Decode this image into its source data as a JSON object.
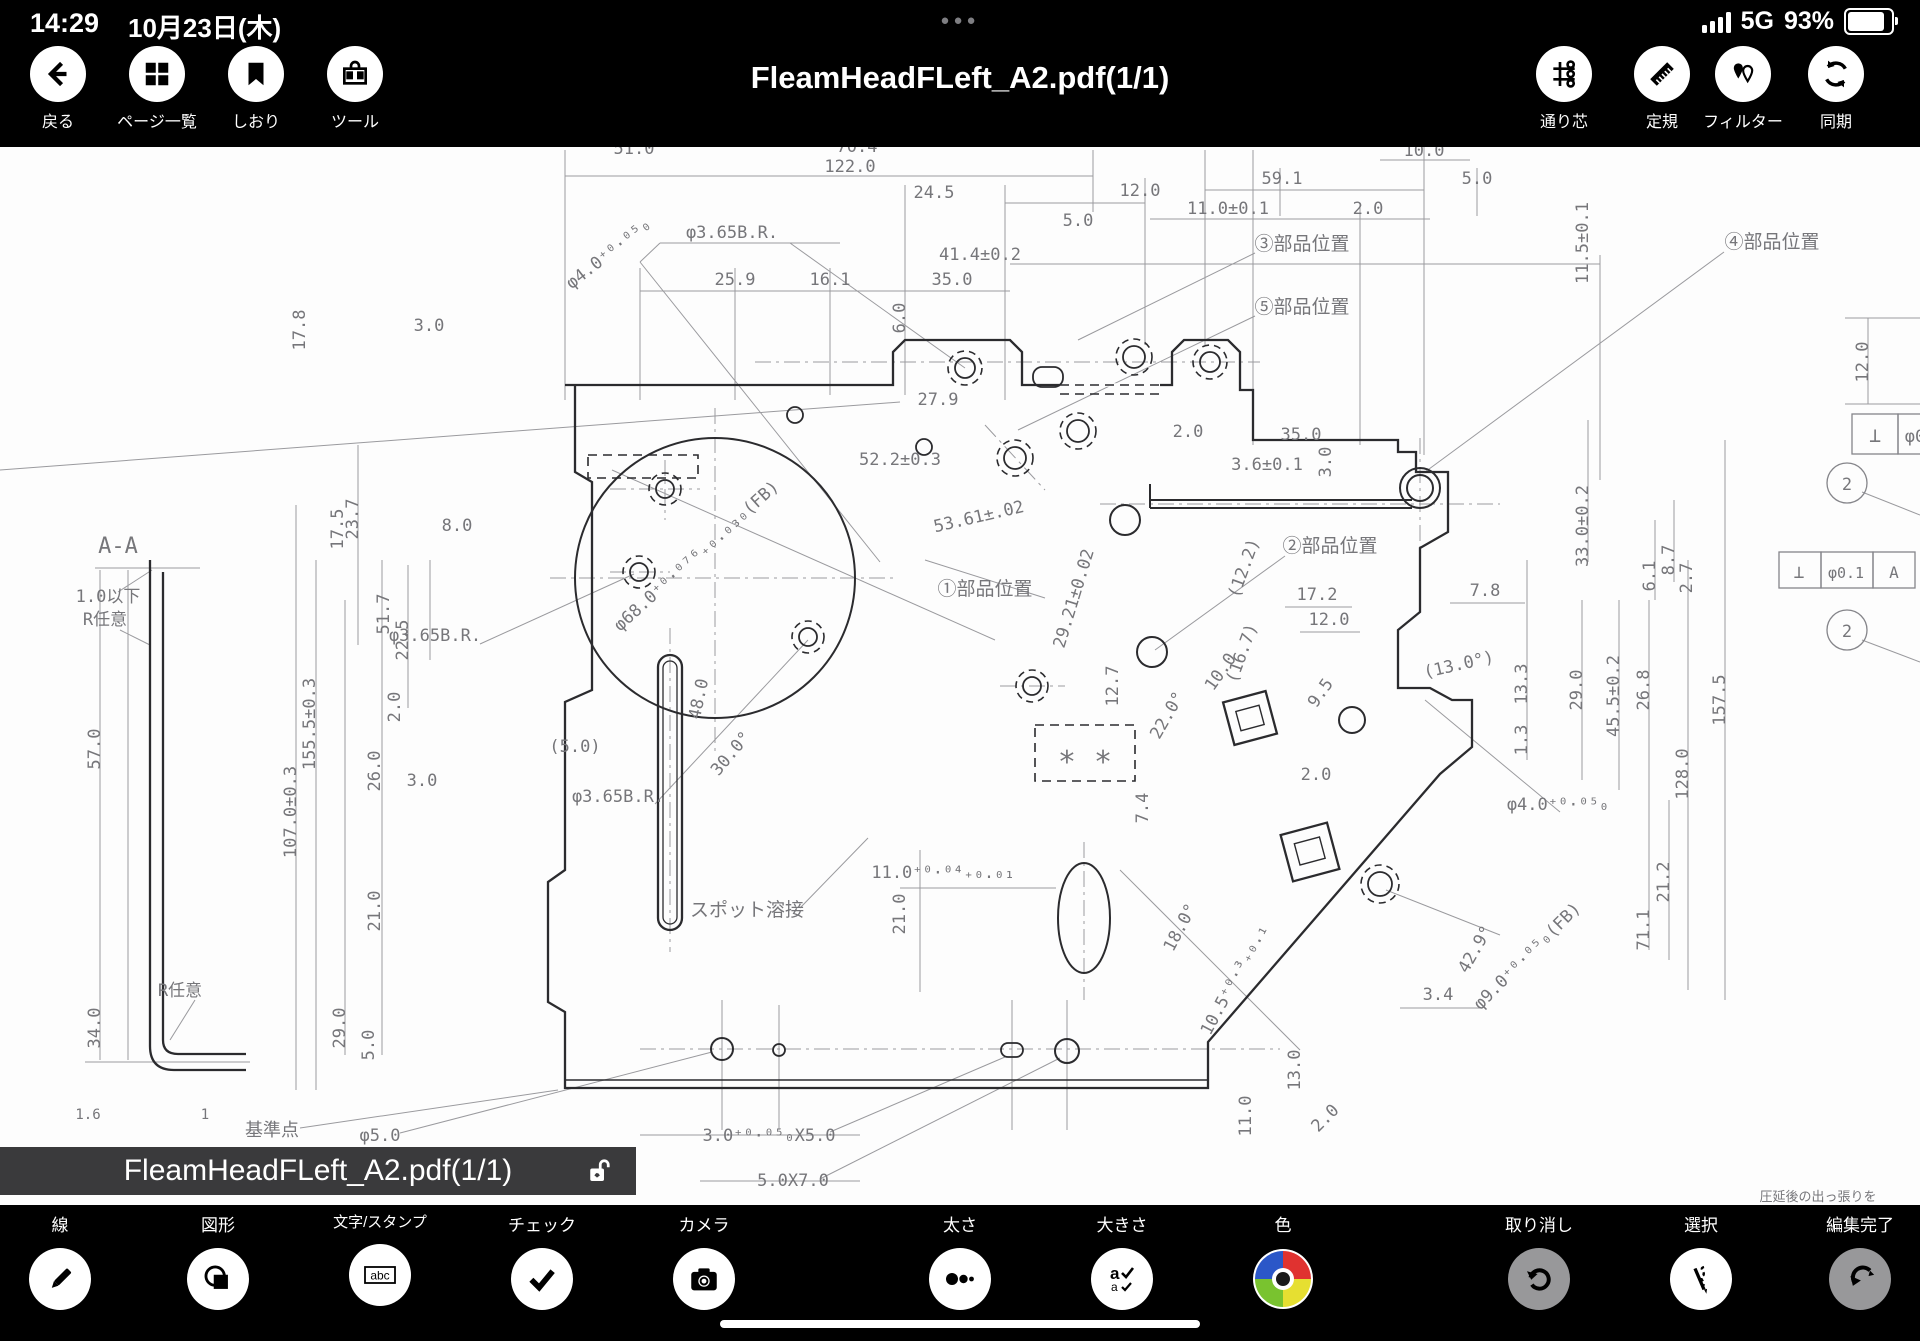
{
  "status_bar": {
    "time": "14:29",
    "date": "10月23日(木)",
    "network": "5G",
    "battery_percent": "93%"
  },
  "nav_bar": {
    "title": "FleamHeadFLeft_A2.pdf(1/1)",
    "left_items": [
      {
        "label": "戻る"
      },
      {
        "label": "ページ一覧"
      },
      {
        "label": "しおり"
      },
      {
        "label": "ツール"
      }
    ],
    "right_items": [
      {
        "label": "通り芯"
      },
      {
        "label": "定規"
      },
      {
        "label": "フィルター"
      },
      {
        "label": "同期"
      }
    ]
  },
  "file_bar": {
    "filename": "FleamHeadFLeft_A2.pdf(1/1)"
  },
  "toolbar": {
    "items": [
      {
        "label": "線"
      },
      {
        "label": "図形"
      },
      {
        "label": "文字/スタンプ"
      },
      {
        "label": "チェック"
      },
      {
        "label": "カメラ"
      },
      {
        "label": "太さ"
      },
      {
        "label": "大きさ"
      },
      {
        "label": "色"
      },
      {
        "label": "取り消し"
      },
      {
        "label": "選択"
      },
      {
        "label": "編集完了"
      }
    ],
    "color_wheel": {
      "blue": "#2b57c8",
      "red": "#e03230",
      "green": "#79c32f",
      "yellow": "#e6df31"
    }
  },
  "drawing": {
    "section_label": "A-A",
    "labels": [
      {
        "t": "51.0",
        "x": 634,
        "y": 154
      },
      {
        "t": "70.4",
        "x": 857,
        "y": 152
      },
      {
        "t": "122.0",
        "x": 850,
        "y": 172
      },
      {
        "t": "24.5",
        "x": 934,
        "y": 198
      },
      {
        "t": "12.0",
        "x": 1140,
        "y": 196
      },
      {
        "t": "5.0",
        "x": 1078,
        "y": 226
      },
      {
        "t": "59.1",
        "x": 1282,
        "y": 184
      },
      {
        "t": "5.0",
        "x": 1477,
        "y": 184
      },
      {
        "t": "10.0",
        "x": 1424,
        "y": 156
      },
      {
        "t": "4.0⁺⁰·⁰⁵X6.0",
        "x": 1273,
        "y": 134
      },
      {
        "t": "41.4±0.2",
        "x": 980,
        "y": 260
      },
      {
        "t": "11.0±0.1",
        "x": 1228,
        "y": 214
      },
      {
        "t": "2.0",
        "x": 1368,
        "y": 214
      },
      {
        "t": "25.9",
        "x": 735,
        "y": 285
      },
      {
        "t": "16.1",
        "x": 830,
        "y": 285
      },
      {
        "t": "35.0",
        "x": 952,
        "y": 285
      },
      {
        "t": "φ3.65B.R.",
        "x": 732,
        "y": 238
      },
      {
        "t": "φ4.0⁺⁰·⁰⁵₀",
        "x": 612,
        "y": 258,
        "r": -38
      },
      {
        "t": "6.0",
        "x": 905,
        "y": 318,
        "r": -90
      },
      {
        "t": "11.5±0.1",
        "x": 1588,
        "y": 243,
        "r": -90
      },
      {
        "t": "④部品位置",
        "x": 1772,
        "y": 248,
        "s": 19
      },
      {
        "t": "③部品位置",
        "x": 1302,
        "y": 250,
        "s": 19
      },
      {
        "t": "⑤部品位置",
        "x": 1302,
        "y": 313,
        "s": 19
      },
      {
        "t": "12.0",
        "x": 1868,
        "y": 362,
        "r": -90
      },
      {
        "t": "17.8",
        "x": 305,
        "y": 330,
        "r": -90
      },
      {
        "t": "3.0",
        "x": 429,
        "y": 331
      },
      {
        "t": "27.9",
        "x": 938,
        "y": 405
      },
      {
        "t": "52.2±0.3",
        "x": 900,
        "y": 465
      },
      {
        "t": "53.61±.02",
        "x": 980,
        "y": 522,
        "r": -13
      },
      {
        "t": "①部品位置",
        "x": 985,
        "y": 595,
        "s": 19
      },
      {
        "t": "φ68.0⁺⁰·⁰⁷⁶₊₀.₀₃₀(FB)",
        "x": 700,
        "y": 560,
        "r": -42
      },
      {
        "t": "2.0",
        "x": 1188,
        "y": 437
      },
      {
        "t": "35.0",
        "x": 1301,
        "y": 440
      },
      {
        "t": "3.6±0.1",
        "x": 1267,
        "y": 470
      },
      {
        "t": "3.0",
        "x": 1331,
        "y": 462,
        "r": -90
      },
      {
        "t": "②部品位置",
        "x": 1330,
        "y": 552,
        "s": 19
      },
      {
        "t": "29.21±0.02",
        "x": 1079,
        "y": 600,
        "r": -73
      },
      {
        "t": "(12.2)",
        "x": 1249,
        "y": 570,
        "r": -70
      },
      {
        "t": "(16.7)",
        "x": 1247,
        "y": 655,
        "r": -70
      },
      {
        "t": "17.2",
        "x": 1317,
        "y": 600
      },
      {
        "t": "12.0",
        "x": 1329,
        "y": 625
      },
      {
        "t": "7.8",
        "x": 1485,
        "y": 596
      },
      {
        "t": "12.7",
        "x": 1118,
        "y": 686,
        "r": -90
      },
      {
        "t": "22.0°",
        "x": 1172,
        "y": 718,
        "r": -60
      },
      {
        "t": "10.0",
        "x": 1225,
        "y": 675,
        "r": -55
      },
      {
        "t": "9.5",
        "x": 1325,
        "y": 696,
        "r": -55
      },
      {
        "t": "(13.0°)",
        "x": 1460,
        "y": 670,
        "r": -13
      },
      {
        "t": "13.3",
        "x": 1527,
        "y": 684,
        "r": -90
      },
      {
        "t": "1.3",
        "x": 1527,
        "y": 740,
        "r": -90
      },
      {
        "t": "29.0",
        "x": 1582,
        "y": 690,
        "r": -90
      },
      {
        "t": "45.5±0.2",
        "x": 1619,
        "y": 696,
        "r": -90
      },
      {
        "t": "26.8",
        "x": 1649,
        "y": 690,
        "r": -90
      },
      {
        "t": "33.0±0.2",
        "x": 1588,
        "y": 526,
        "r": -90
      },
      {
        "t": "6.1",
        "x": 1655,
        "y": 576,
        "r": -90
      },
      {
        "t": "8.7",
        "x": 1674,
        "y": 560,
        "r": -90
      },
      {
        "t": "2.7",
        "x": 1692,
        "y": 578,
        "r": -90
      },
      {
        "t": "157.5",
        "x": 1725,
        "y": 700,
        "r": -90
      },
      {
        "t": "128.0",
        "x": 1688,
        "y": 774,
        "r": -90
      },
      {
        "t": "71.1",
        "x": 1649,
        "y": 930,
        "r": -90
      },
      {
        "t": "21.2",
        "x": 1669,
        "y": 882,
        "r": -90
      },
      {
        "t": "42.9°",
        "x": 1480,
        "y": 952,
        "r": -60
      },
      {
        "t": "φ4.0⁺⁰·⁰⁵₀",
        "x": 1558,
        "y": 810
      },
      {
        "t": "φ9.0⁺⁰·⁰⁵₀(FB)",
        "x": 1531,
        "y": 960,
        "r": -45
      },
      {
        "t": "3.4",
        "x": 1438,
        "y": 1000
      },
      {
        "t": "13.0",
        "x": 1300,
        "y": 1070,
        "r": -90
      },
      {
        "t": "11.0",
        "x": 1251,
        "y": 1116,
        "r": -90
      },
      {
        "t": "2.0",
        "x": 1329,
        "y": 1122,
        "r": -45
      },
      {
        "t": "18.0°",
        "x": 1185,
        "y": 930,
        "r": -62
      },
      {
        "t": "10.5⁺⁰·³₊₀.₁",
        "x": 1239,
        "y": 982,
        "r": -62
      },
      {
        "t": "7.4",
        "x": 1148,
        "y": 808,
        "r": -90
      },
      {
        "t": "2.0",
        "x": 1316,
        "y": 780
      },
      {
        "t": "* *",
        "x": 1085,
        "y": 772,
        "s": 30
      },
      {
        "t": "スポット溶接",
        "x": 747,
        "y": 916,
        "s": 19
      },
      {
        "t": "11.0⁺⁰·⁰⁴₊₀.₀₁",
        "x": 943,
        "y": 878
      },
      {
        "t": "21.0",
        "x": 905,
        "y": 914,
        "r": -90
      },
      {
        "t": "3.0⁺⁰·⁰⁵₀X5.0",
        "x": 769,
        "y": 1141
      },
      {
        "t": "5.0X7.0",
        "x": 793,
        "y": 1186
      },
      {
        "t": "基準点",
        "x": 272,
        "y": 1136,
        "s": 18
      },
      {
        "t": "φ5.0",
        "x": 380,
        "y": 1141
      },
      {
        "t": "(5.0)",
        "x": 575,
        "y": 752
      },
      {
        "t": "φ3.65B.R.",
        "x": 435,
        "y": 641
      },
      {
        "t": "φ3.65B.R.",
        "x": 618,
        "y": 802
      },
      {
        "t": "30.0°",
        "x": 735,
        "y": 757,
        "r": -50
      },
      {
        "t": "48.0",
        "x": 704,
        "y": 700,
        "r": -78
      },
      {
        "t": "3.0",
        "x": 422,
        "y": 786
      },
      {
        "t": "26.0",
        "x": 380,
        "y": 771,
        "r": -90
      },
      {
        "t": "2.0",
        "x": 400,
        "y": 707,
        "r": -90
      },
      {
        "t": "22.5",
        "x": 408,
        "y": 640,
        "r": -90
      },
      {
        "t": "51.7",
        "x": 389,
        "y": 614,
        "r": -90
      },
      {
        "t": "17.5",
        "x": 343,
        "y": 529,
        "r": -90
      },
      {
        "t": "23.7",
        "x": 358,
        "y": 519,
        "r": -90
      },
      {
        "t": "8.0",
        "x": 457,
        "y": 531
      },
      {
        "t": "155.5±0.3",
        "x": 315,
        "y": 724,
        "r": -90
      },
      {
        "t": "107.0±0.3",
        "x": 296,
        "y": 812,
        "r": -90
      },
      {
        "t": "57.0",
        "x": 100,
        "y": 749,
        "r": -90
      },
      {
        "t": "34.0",
        "x": 100,
        "y": 1028,
        "r": -90
      },
      {
        "t": "29.0",
        "x": 345,
        "y": 1028,
        "r": -90
      },
      {
        "t": "21.0",
        "x": 380,
        "y": 911,
        "r": -90
      },
      {
        "t": "5.0",
        "x": 374,
        "y": 1045,
        "r": -90
      },
      {
        "t": "A-A",
        "x": 118,
        "y": 553,
        "s": 22
      },
      {
        "t": "1.0以下",
        "x": 108,
        "y": 602,
        "s": 17
      },
      {
        "t": "R任意",
        "x": 105,
        "y": 625,
        "s": 17
      },
      {
        "t": "R任意",
        "x": 180,
        "y": 996,
        "s": 17
      },
      {
        "t": "1.6",
        "x": 88,
        "y": 1119,
        "s": 14
      },
      {
        "t": "1",
        "x": 205,
        "y": 1119,
        "s": 14
      },
      {
        "t": "圧延後の出っ張りを",
        "x": 1818,
        "y": 1201,
        "s": 13
      },
      {
        "t": "⊥",
        "x": 1875,
        "y": 442,
        "s": 20
      },
      {
        "t": "φ0",
        "x": 1915,
        "y": 442
      },
      {
        "t": "⊥",
        "x": 1799,
        "y": 578,
        "s": 18
      },
      {
        "t": "φ0.1",
        "x": 1846,
        "y": 578,
        "s": 15
      },
      {
        "t": "A",
        "x": 1894,
        "y": 578,
        "s": 16
      },
      {
        "t": "2",
        "x": 1847,
        "y": 490,
        "s": 17
      },
      {
        "t": "2",
        "x": 1847,
        "y": 637,
        "s": 17
      }
    ]
  }
}
